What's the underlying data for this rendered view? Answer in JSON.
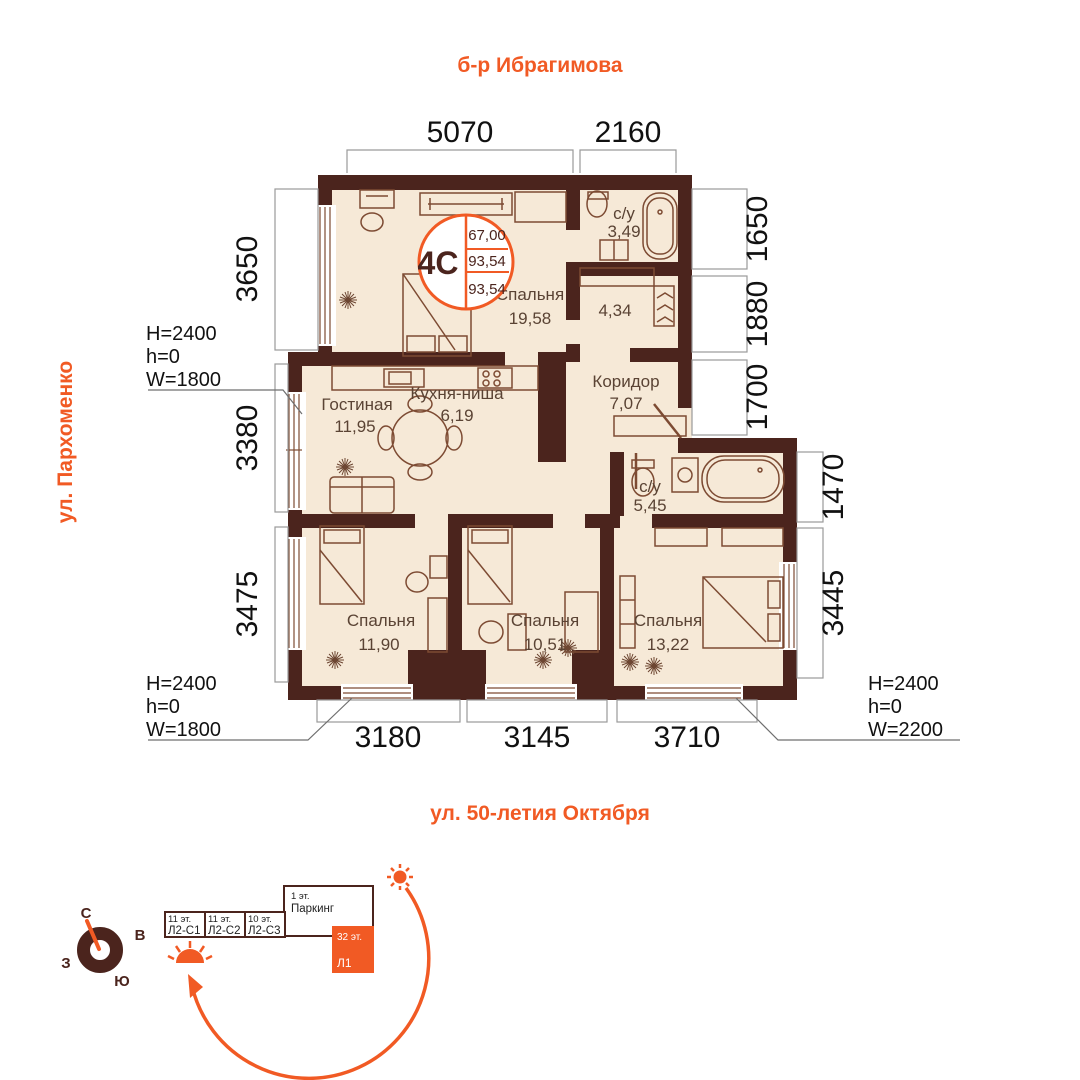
{
  "streets": {
    "top": "б-р Ибрагимова",
    "left": "ул. Пархоменко",
    "bottom": "ул. 50-летия Октября"
  },
  "unit_badge": {
    "type": "4С",
    "values": [
      "67,00",
      "93,54",
      "93,54"
    ]
  },
  "rooms": {
    "bedroom_main": {
      "name": "Спальня",
      "area": "19,58"
    },
    "bathroom_top": {
      "name": "с/у",
      "area": "3,49"
    },
    "wardrobe": {
      "area": "4,34"
    },
    "corridor": {
      "name": "Коридор",
      "area": "7,07"
    },
    "living": {
      "name": "Гостиная",
      "area": "11,95"
    },
    "kitchen": {
      "name": "Кухня-ниша",
      "area": "6,19"
    },
    "bathroom_mid": {
      "name": "с/у",
      "area": "5,45"
    },
    "bedroom_left": {
      "name": "Спальня",
      "area": "11,90"
    },
    "bedroom_center": {
      "name": "Спальня",
      "area": "10,51"
    },
    "bedroom_right": {
      "name": "Спальня",
      "area": "13,22"
    }
  },
  "dimensions": {
    "top": [
      "5070",
      "2160"
    ],
    "left": [
      "3650",
      "3380",
      "3475"
    ],
    "right_inner": [
      "1650",
      "1880",
      "1700"
    ],
    "right_outer": [
      "1470",
      "3445"
    ],
    "bottom": [
      "3180",
      "3145",
      "3710"
    ]
  },
  "window_labels": {
    "upper_left": [
      "H=2400",
      "h=0",
      "W=1800"
    ],
    "lower_left": [
      "H=2400",
      "h=0",
      "W=1800"
    ],
    "lower_right": [
      "H=2400",
      "h=0",
      "W=2200"
    ]
  },
  "compass": {
    "north": "С",
    "east": "В",
    "west": "З",
    "south": "Ю"
  },
  "site_plan": {
    "buildings": [
      {
        "floors": "11 эт.",
        "name": "Л2-С1"
      },
      {
        "floors": "11 эт.",
        "name": "Л2-С2"
      },
      {
        "floors": "10 эт.",
        "name": "Л2-С3"
      },
      {
        "floors": "1 эт.",
        "name": "Паркинг"
      },
      {
        "floors": "32 эт.",
        "name": "Л1",
        "highlighted": true
      }
    ]
  },
  "colors": {
    "accent": "#f15a24",
    "wall": "#4b241d",
    "floor": "#f6e9d7"
  }
}
